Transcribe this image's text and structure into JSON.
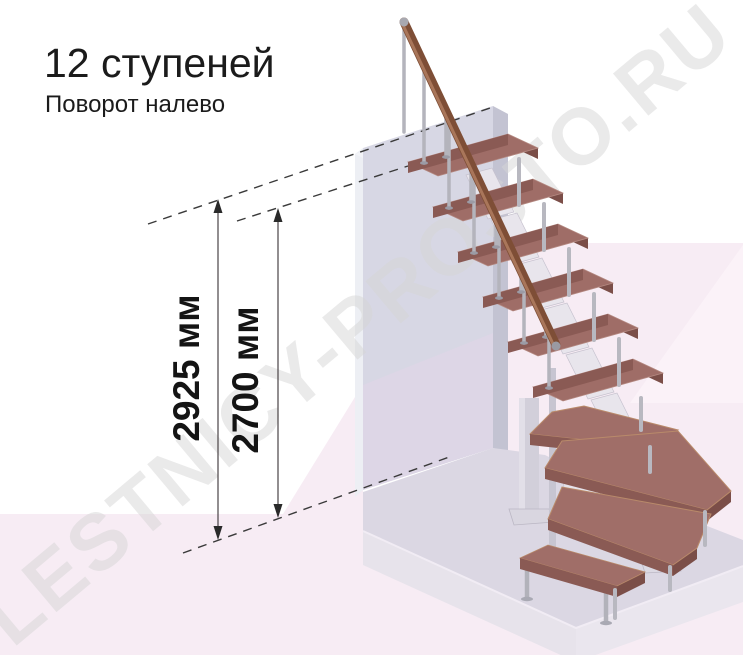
{
  "header": {
    "title": "12 ступеней",
    "subtitle": "Поворот налево"
  },
  "dimensions": {
    "overall_height": {
      "label": "2925 мм"
    },
    "to_top_step": {
      "label": "2700 мм"
    }
  },
  "watermark": {
    "text": "LESTNICY-PROSTO.RU"
  },
  "stairs": {
    "step_count": "12",
    "turn_direction": "налево",
    "colors": {
      "tread_top": "#9f6d67",
      "tread_front": "#8a5a54",
      "handrail": "#7e4e36",
      "baluster": "#b6b6c0",
      "wall": "#d7d7e4",
      "floor_pink": "#f7ecf4",
      "platform": "#dbd7e3",
      "dimension_line": "#3a3537",
      "text": "#1b1b1b",
      "watermark": "#d6d6d6"
    }
  }
}
